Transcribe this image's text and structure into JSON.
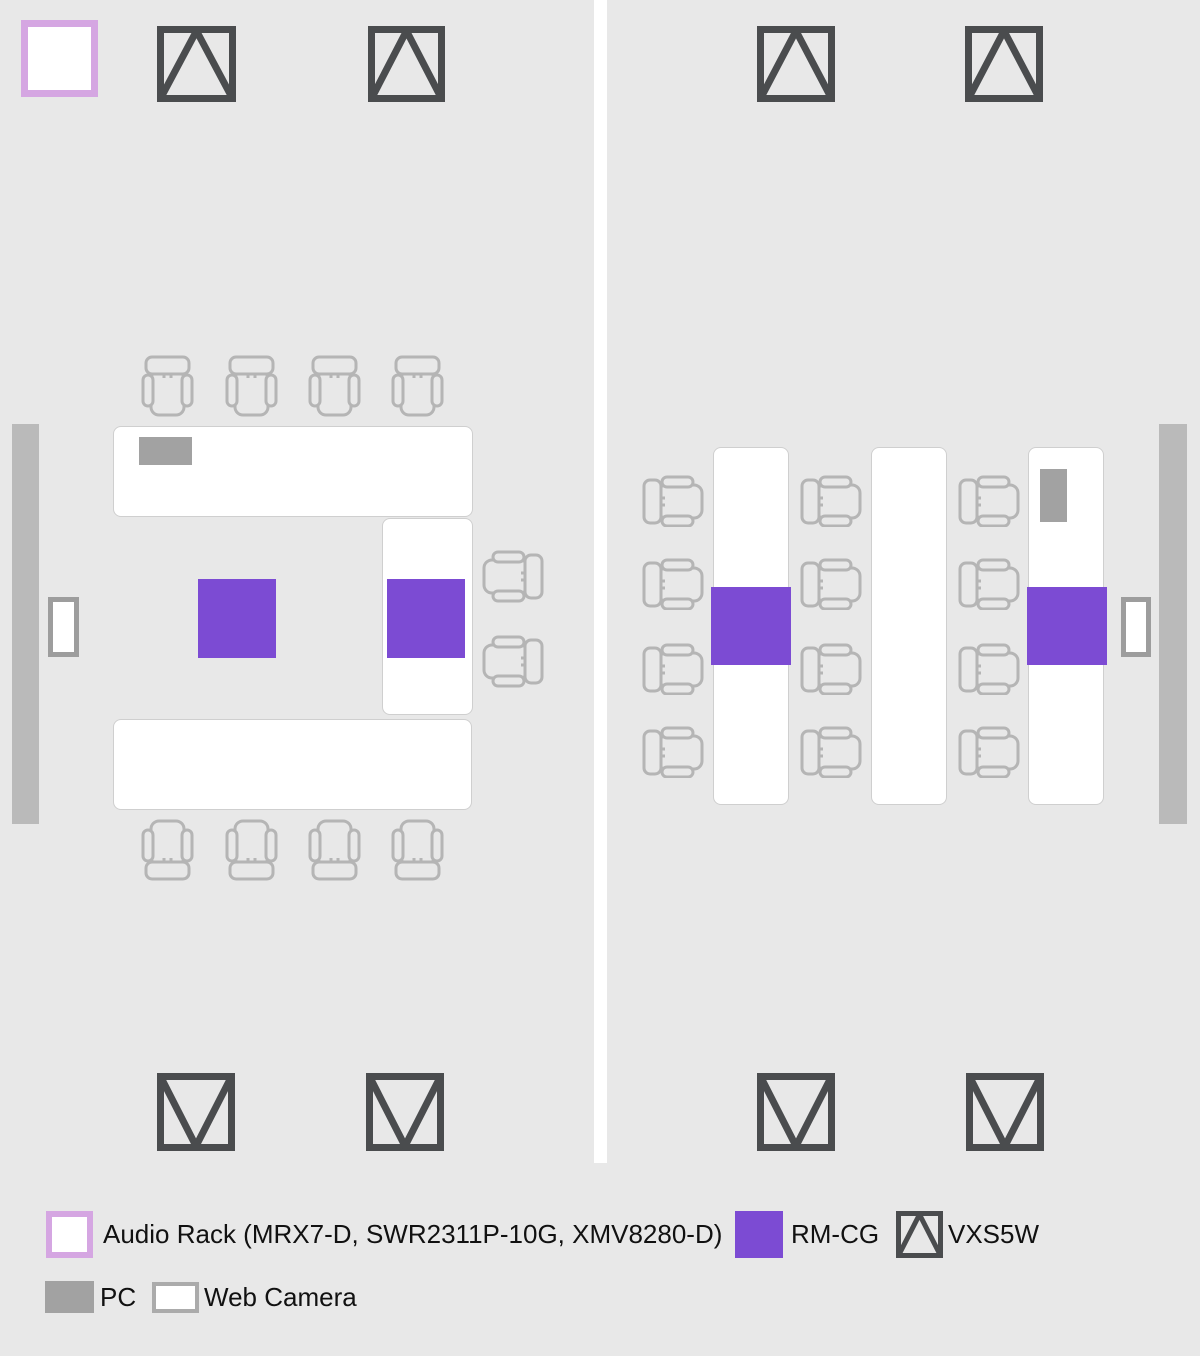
{
  "title": "Meeting room AV layout floor plan",
  "colors": {
    "background": "#e8e8e8",
    "purple_rmcg": "#7c4bd3",
    "lavender_rack_border": "#d5a6e2",
    "speaker_stroke": "#4a4c4e",
    "chair_stroke": "#b5b5b5",
    "display_gray": "#bababa",
    "pc_gray": "#a2a2a2",
    "webcam_border": "#9d9d9d",
    "table_fill": "#ffffff",
    "text": "#111111"
  },
  "legend": {
    "audio_rack_label": "Audio Rack (MRX7-D, SWR2311P-10G, XMV8280-D)",
    "rmcg_label": "RM-CG",
    "vxs5w_label": "VXS5W",
    "pc_label": "PC",
    "web_camera_label": "Web Camera"
  },
  "floorplan": {
    "divider": {
      "x": 594,
      "y": 0,
      "w": 13,
      "h": 1163
    },
    "items": [
      {
        "type": "audio-rack",
        "x": 21,
        "y": 20,
        "w": 77,
        "h": 77
      },
      {
        "type": "speaker",
        "dir": "up",
        "x": 157,
        "y": 26,
        "w": 79,
        "h": 76
      },
      {
        "type": "speaker",
        "dir": "up",
        "x": 368,
        "y": 26,
        "w": 77,
        "h": 76
      },
      {
        "type": "speaker",
        "dir": "up",
        "x": 757,
        "y": 26,
        "w": 78,
        "h": 76
      },
      {
        "type": "speaker",
        "dir": "up",
        "x": 965,
        "y": 26,
        "w": 78,
        "h": 76
      },
      {
        "type": "speaker",
        "dir": "down",
        "x": 157,
        "y": 1073,
        "w": 78,
        "h": 78
      },
      {
        "type": "speaker",
        "dir": "down",
        "x": 366,
        "y": 1073,
        "w": 78,
        "h": 78
      },
      {
        "type": "speaker",
        "dir": "down",
        "x": 757,
        "y": 1073,
        "w": 78,
        "h": 78
      },
      {
        "type": "speaker",
        "dir": "down",
        "x": 966,
        "y": 1073,
        "w": 78,
        "h": 78
      },
      {
        "type": "display",
        "x": 12,
        "y": 424,
        "w": 27,
        "h": 400
      },
      {
        "type": "display",
        "x": 1159,
        "y": 424,
        "w": 28,
        "h": 400
      },
      {
        "type": "webcam",
        "x": 48,
        "y": 597,
        "w": 31,
        "h": 60
      },
      {
        "type": "webcam",
        "x": 1121,
        "y": 597,
        "w": 30,
        "h": 60
      },
      {
        "type": "table",
        "x": 113,
        "y": 426,
        "w": 360,
        "h": 91
      },
      {
        "type": "table",
        "x": 382,
        "y": 518,
        "w": 91,
        "h": 197
      },
      {
        "type": "table",
        "x": 113,
        "y": 719,
        "w": 359,
        "h": 91
      },
      {
        "type": "table",
        "x": 713,
        "y": 447,
        "w": 76,
        "h": 358
      },
      {
        "type": "table",
        "x": 871,
        "y": 447,
        "w": 76,
        "h": 358
      },
      {
        "type": "table",
        "x": 1028,
        "y": 447,
        "w": 76,
        "h": 358
      },
      {
        "type": "pc",
        "x": 139,
        "y": 437,
        "w": 53,
        "h": 28
      },
      {
        "type": "pc",
        "x": 1040,
        "y": 469,
        "w": 27,
        "h": 53
      },
      {
        "type": "rmcg",
        "x": 198,
        "y": 579,
        "w": 78,
        "h": 79
      },
      {
        "type": "rmcg",
        "x": 387,
        "y": 579,
        "w": 78,
        "h": 79
      },
      {
        "type": "rmcg",
        "x": 711,
        "y": 587,
        "w": 80,
        "h": 78
      },
      {
        "type": "rmcg",
        "x": 1027,
        "y": 587,
        "w": 80,
        "h": 78
      },
      {
        "type": "chair",
        "dir": "down",
        "x": 141,
        "y": 355,
        "w": 53,
        "h": 62
      },
      {
        "type": "chair",
        "dir": "down",
        "x": 225,
        "y": 355,
        "w": 53,
        "h": 62
      },
      {
        "type": "chair",
        "dir": "down",
        "x": 308,
        "y": 355,
        "w": 53,
        "h": 62
      },
      {
        "type": "chair",
        "dir": "down",
        "x": 391,
        "y": 355,
        "w": 53,
        "h": 62
      },
      {
        "type": "chair",
        "dir": "up",
        "x": 141,
        "y": 819,
        "w": 53,
        "h": 62
      },
      {
        "type": "chair",
        "dir": "up",
        "x": 225,
        "y": 819,
        "w": 53,
        "h": 62
      },
      {
        "type": "chair",
        "dir": "up",
        "x": 308,
        "y": 819,
        "w": 53,
        "h": 62
      },
      {
        "type": "chair",
        "dir": "up",
        "x": 391,
        "y": 819,
        "w": 53,
        "h": 62
      },
      {
        "type": "chair",
        "dir": "left",
        "x": 482,
        "y": 550,
        "w": 62,
        "h": 53
      },
      {
        "type": "chair",
        "dir": "left",
        "x": 482,
        "y": 635,
        "w": 62,
        "h": 53
      },
      {
        "type": "chair",
        "dir": "right",
        "x": 642,
        "y": 475,
        "w": 62,
        "h": 52
      },
      {
        "type": "chair",
        "dir": "right",
        "x": 642,
        "y": 558,
        "w": 62,
        "h": 52
      },
      {
        "type": "chair",
        "dir": "right",
        "x": 642,
        "y": 643,
        "w": 62,
        "h": 52
      },
      {
        "type": "chair",
        "dir": "right",
        "x": 642,
        "y": 726,
        "w": 62,
        "h": 52
      },
      {
        "type": "chair",
        "dir": "right",
        "x": 800,
        "y": 475,
        "w": 62,
        "h": 52
      },
      {
        "type": "chair",
        "dir": "right",
        "x": 800,
        "y": 558,
        "w": 62,
        "h": 52
      },
      {
        "type": "chair",
        "dir": "right",
        "x": 800,
        "y": 643,
        "w": 62,
        "h": 52
      },
      {
        "type": "chair",
        "dir": "right",
        "x": 800,
        "y": 726,
        "w": 62,
        "h": 52
      },
      {
        "type": "chair",
        "dir": "right",
        "x": 958,
        "y": 475,
        "w": 62,
        "h": 52
      },
      {
        "type": "chair",
        "dir": "right",
        "x": 958,
        "y": 558,
        "w": 62,
        "h": 52
      },
      {
        "type": "chair",
        "dir": "right",
        "x": 958,
        "y": 643,
        "w": 62,
        "h": 52
      },
      {
        "type": "chair",
        "dir": "right",
        "x": 958,
        "y": 726,
        "w": 62,
        "h": 52
      }
    ]
  }
}
